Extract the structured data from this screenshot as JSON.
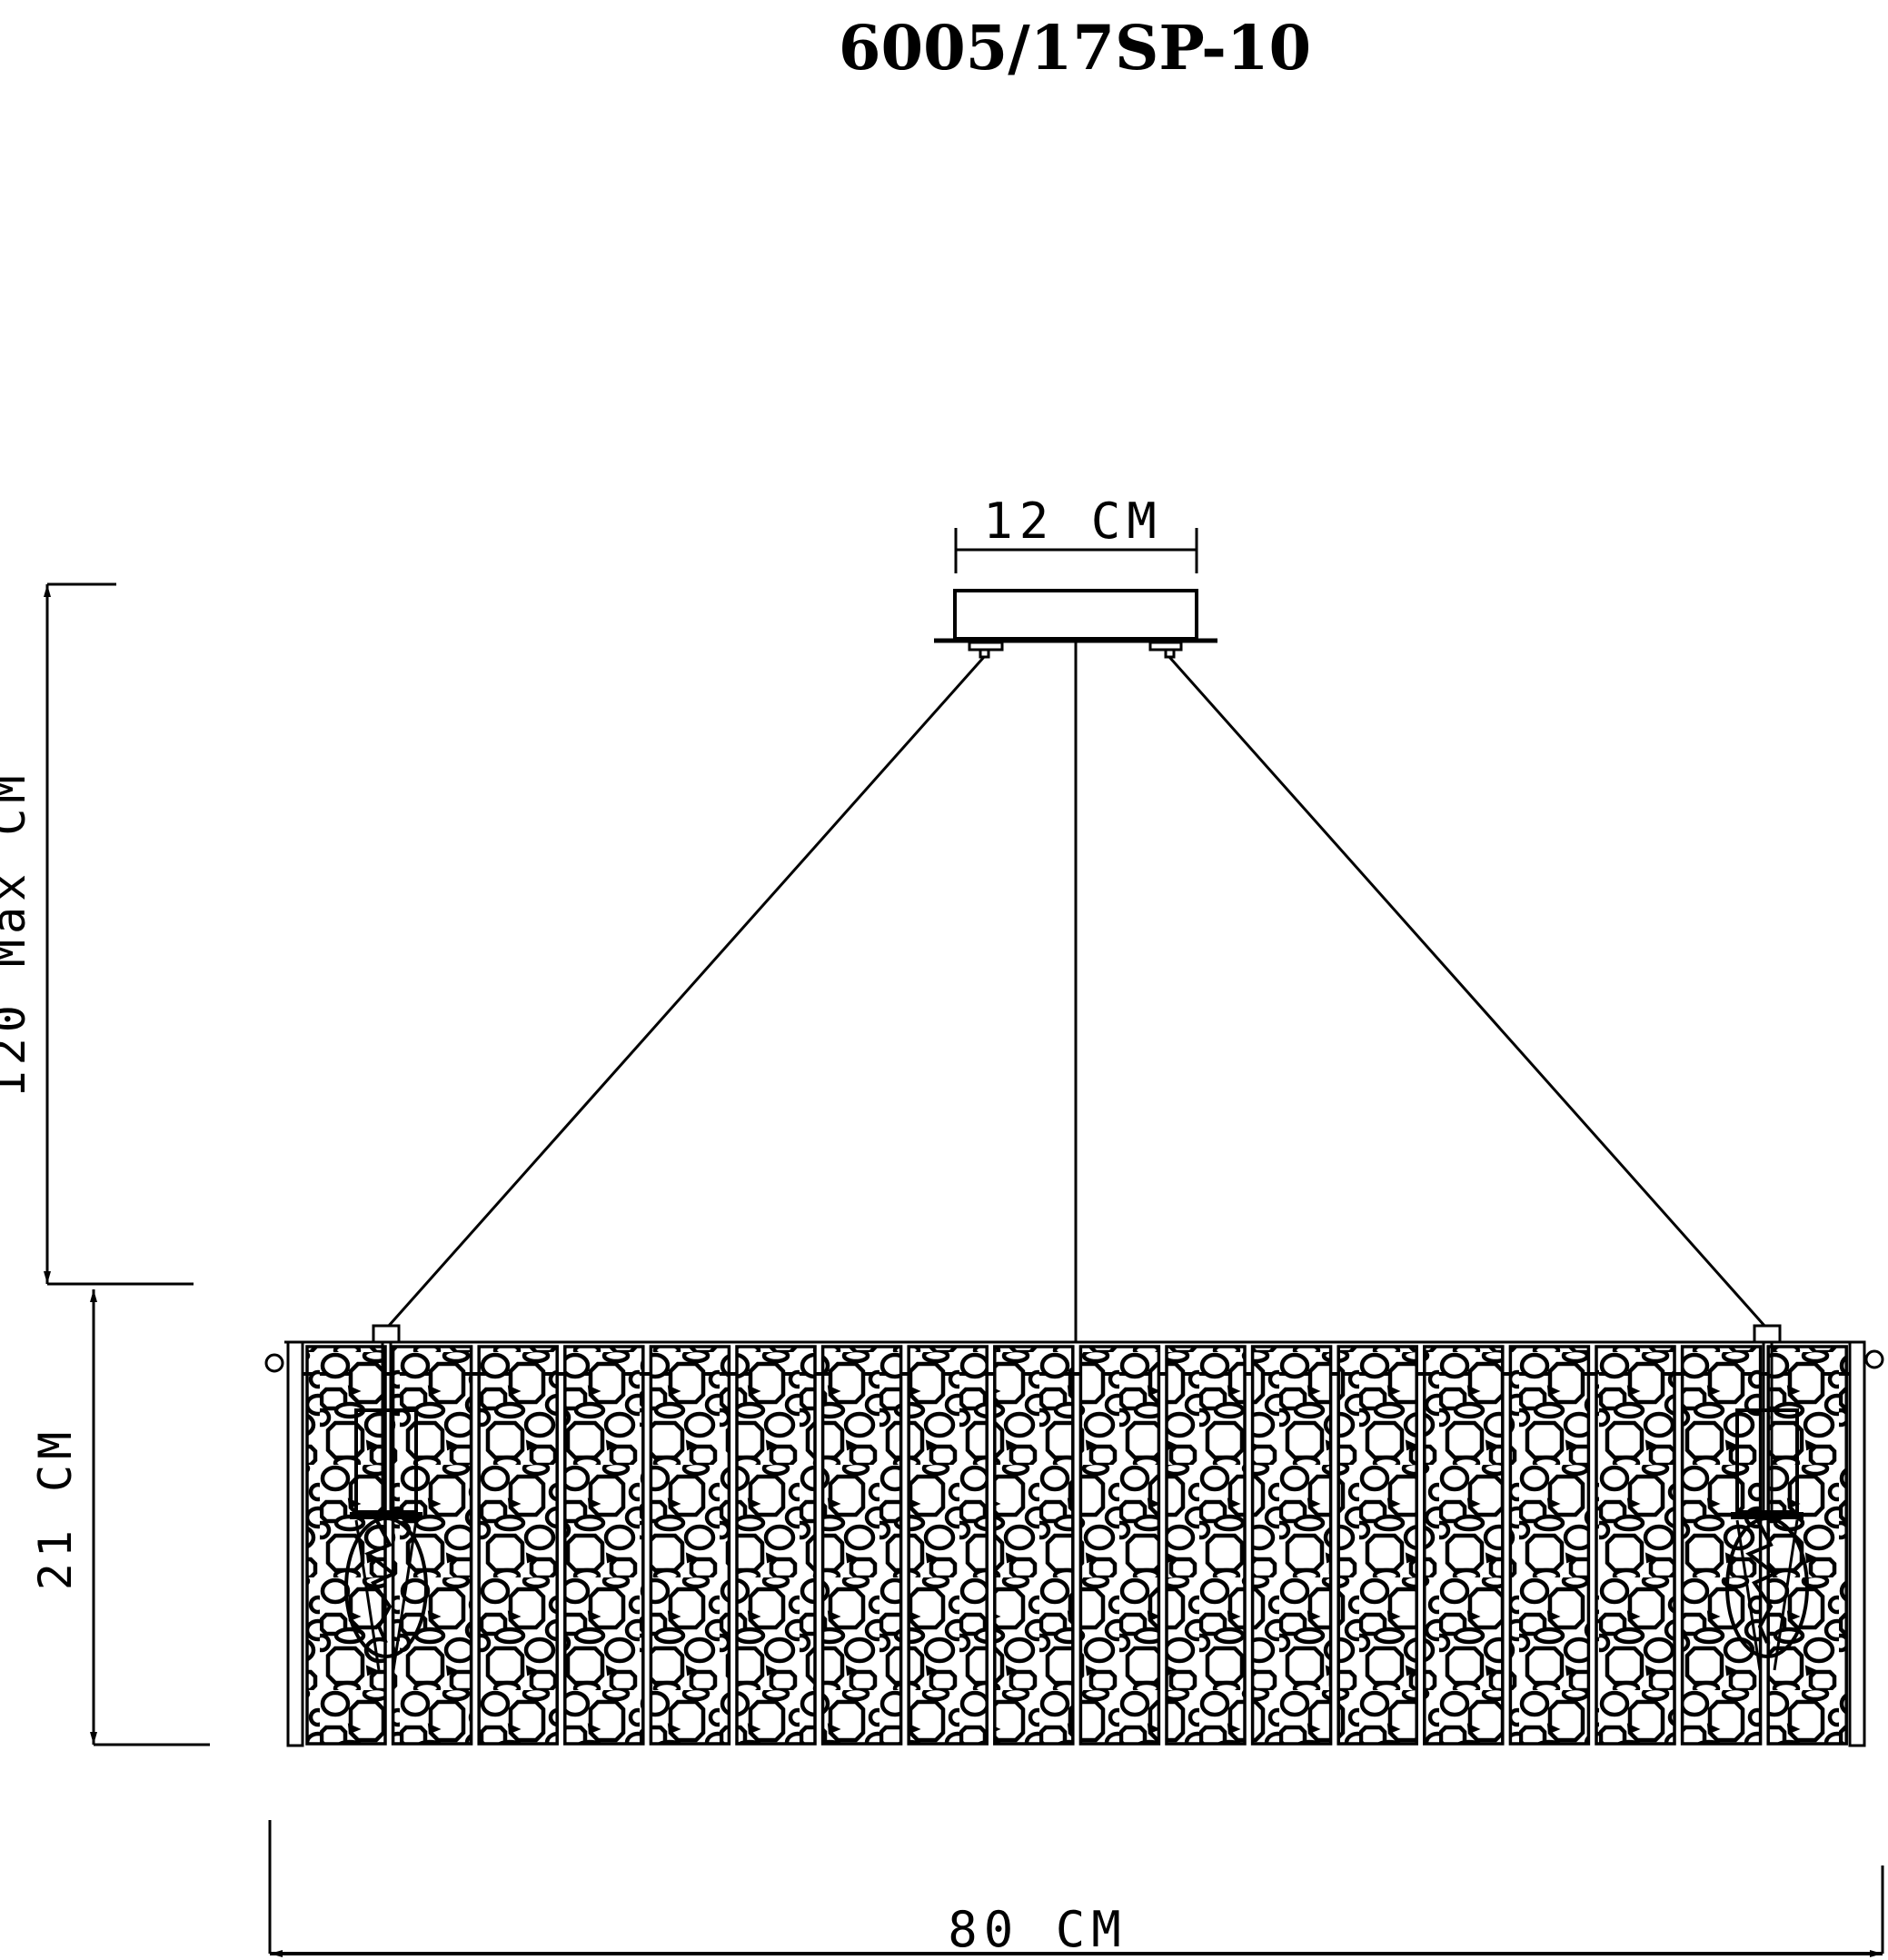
{
  "title": "6005/17SP-10",
  "dimensions": {
    "canopy_width": {
      "value": 12,
      "unit": "CM",
      "label": "12 CM"
    },
    "drop_max": {
      "value": 120,
      "unit": "CM",
      "label": "120 Max CM"
    },
    "body_height": {
      "value": 21,
      "unit": "CM",
      "label": "21 CM"
    },
    "body_width": {
      "value": 80,
      "unit": "CM",
      "label": "80 CM"
    }
  },
  "structure": {
    "panel_count": 18,
    "bulb_count": 2,
    "suspension_wire_count": 3
  },
  "colors": {
    "ink": "#000000",
    "paper": "#ffffff"
  }
}
